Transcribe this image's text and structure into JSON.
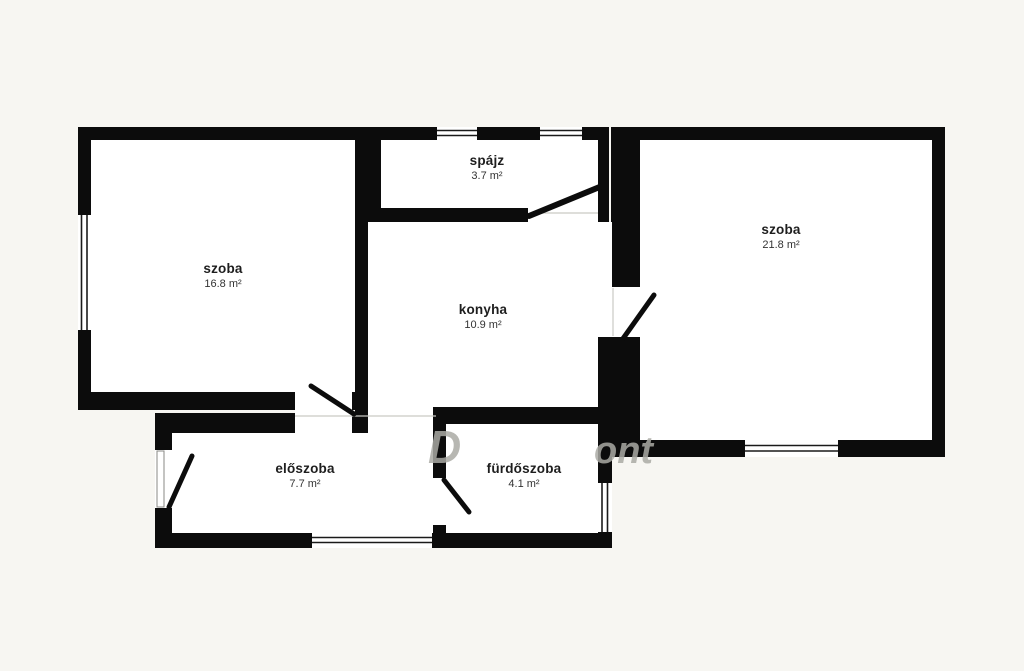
{
  "canvas": {
    "background_color": "#f7f6f2",
    "wall_color": "#0c0c0c",
    "floor_color": "#ffffff"
  },
  "floorplan": {
    "rooms": [
      {
        "id": "szoba-left",
        "name": "szoba",
        "area": "16.8 m²"
      },
      {
        "id": "spajz",
        "name": "spájz",
        "area": "3.7 m²"
      },
      {
        "id": "konyha",
        "name": "konyha",
        "area": "10.9 m²"
      },
      {
        "id": "szoba-right",
        "name": "szoba",
        "area": "21.8 m²"
      },
      {
        "id": "eloszoba",
        "name": "előszoba",
        "area": "7.7 m²"
      },
      {
        "id": "furdoszoba",
        "name": "fürdőszoba",
        "area": "4.1 m²"
      }
    ],
    "watermark_fragments": [
      "D",
      "ont"
    ]
  }
}
